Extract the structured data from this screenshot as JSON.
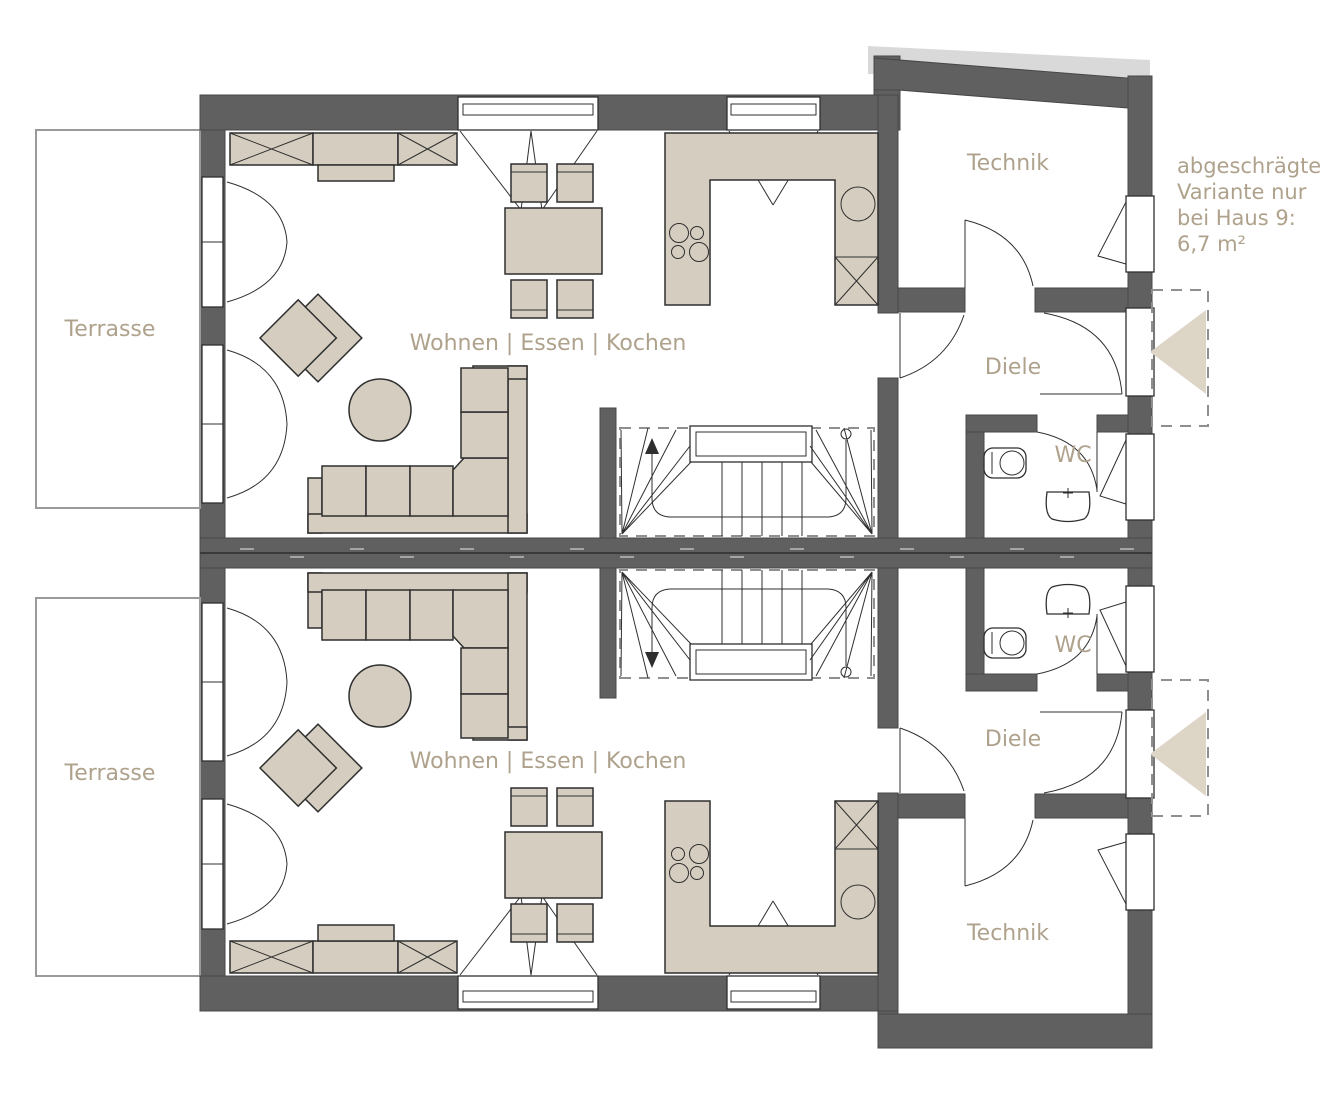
{
  "labels": {
    "terrace": "Terrasse",
    "living": "Wohnen | Essen | Kochen",
    "technik": "Technik",
    "hall": "Diele",
    "wc": "WC"
  },
  "annotation": {
    "line1": "abgeschrägte",
    "line2": "Variante nur",
    "line3": "bei Haus 9:",
    "line4": "6,7 m²"
  },
  "colors": {
    "wall": "#606060",
    "furniture": "#d5cec0",
    "label_text": "#afa28c",
    "shadow": "#d9d9d9",
    "entry_arrow": "#ddd6c7"
  }
}
